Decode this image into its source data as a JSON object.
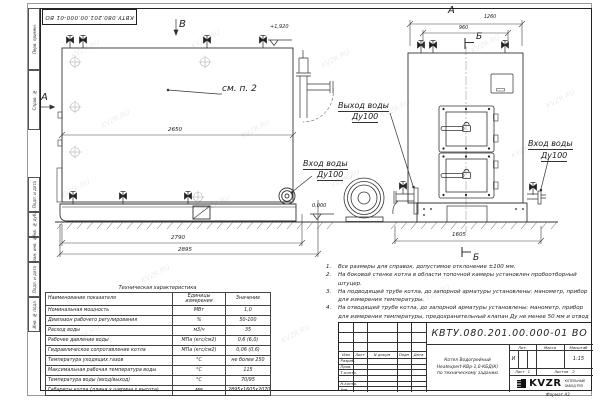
{
  "watermark": "KVZR.RU",
  "stamp_top": "КВТУ.080.201.00.000-01  ВО",
  "margin_labels": [
    "Перв. примен.",
    "Справ. №",
    "Подп. и дата",
    "Инв. № дубл.",
    "Взам. инв. №",
    "Подп. и дата",
    "Инв. № подл."
  ],
  "drawing": {
    "view_b": "В",
    "view_a_side": "А",
    "view_a_front": "А",
    "elev_top": "+1,920",
    "elev_zero": "0.000",
    "see_note": "см. п. 2",
    "section_b_top": "Б",
    "section_b_bottom": "Б",
    "dim_2650": "2650",
    "dim_2790": "2790",
    "dim_2895": "2895",
    "dim_1260": "1260",
    "dim_960": "960",
    "dim_1605": "1605",
    "outlet_l1": "Выход воды",
    "outlet_l2": "Ду100",
    "inlet_left_l1": "Вход воды",
    "inlet_left_l2": "Ду100",
    "inlet_right_l1": "Вход воды",
    "inlet_right_l2": "Ду100"
  },
  "notes": {
    "items": [
      {
        "num": "1.",
        "text": "Все размеры для справок, допустимое отклонение ±100 мм."
      },
      {
        "num": "2.",
        "text": "На боковой стенке котла в области топочной камеры установлен пробоотборный штуцер."
      },
      {
        "num": "3.",
        "text": "На подводящей трубе котла, до запорной арматуры установлены: манометр, прибор для измерения температуры."
      },
      {
        "num": "4.",
        "text": "На отводящей трубе котла, до запорной арматуры установлены: манометр, прибор для измерения температуры, предохранительный клапан Ду не менее 50 мм и отвод с обратным клапаном Ду не менее 50 мм."
      }
    ]
  },
  "table": {
    "title": "Техническая характеристика",
    "headers": [
      "Наименование показателя",
      "Единицы измерения",
      "Значение"
    ],
    "rows": [
      {
        "name": "Номинальная мощность",
        "unit": "МВт",
        "value": "1,0"
      },
      {
        "name": "Диапазон рабочего регулирования",
        "unit": "%",
        "value": "50-100"
      },
      {
        "name": "Расход воды",
        "unit": "м3/ч",
        "value": "35"
      },
      {
        "name": "Рабочее давление воды",
        "unit": "МПа (кгс/см2)",
        "value": "0,6 (6,0)"
      },
      {
        "name": "Гидравлическое сопротивление котла",
        "unit": "МПа (кгс/см2)",
        "value": "0,06 (0,6)"
      },
      {
        "name": "Температура уходящих газов",
        "unit": "°С",
        "value": "не более 250"
      },
      {
        "name": "Максимальная рабочая температура воды",
        "unit": "°С",
        "value": "115"
      },
      {
        "name": "Температура воды (вход/выход)",
        "unit": "°С",
        "value": "70/95"
      },
      {
        "name": "Габариты котла (длина х ширина х высота)",
        "unit": "мм",
        "value": "2895х1605х2070"
      }
    ]
  },
  "titleblock": {
    "doc_number": "КВТУ.080.201.00.000-01  ВО",
    "product_line1": "Котел Водогрейный",
    "product_line2": "Heatexpert-КВр-1,0-КБД(К)",
    "product_line3": "по техническому заданию",
    "cols": {
      "izm": "Изм",
      "list": "Лист",
      "ndoc": "N докум",
      "podp": "Подп",
      "data": "Дата"
    },
    "roles": [
      "Разраб.",
      "Пров.",
      "Т.контр.",
      "Н.контр.",
      "Утв."
    ],
    "lit_header": "Лит.",
    "mass_header": "Масса",
    "scale_header": "Масштаб",
    "lit_value": "И",
    "scale_value": "1:15",
    "sheet_label": "Лист",
    "sheet_value": "1",
    "sheets_label": "Листов",
    "sheets_value": "2",
    "logo_text": "KVZR",
    "logo_sub1": "КОТЕЛЬНЫЙ",
    "logo_sub2": "ЗАВОД РЭП",
    "format_label": "Формат  А3"
  }
}
